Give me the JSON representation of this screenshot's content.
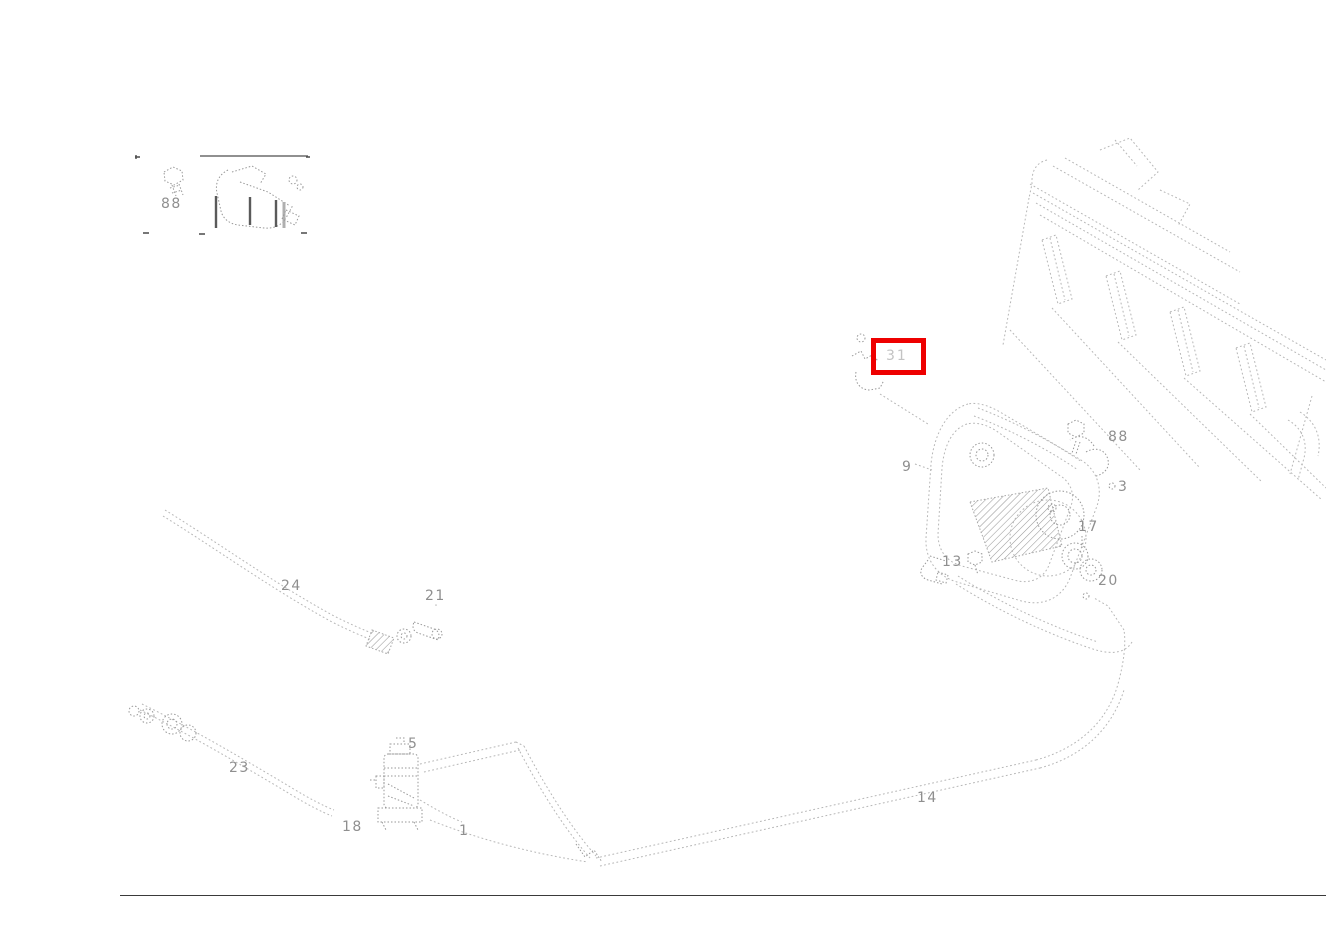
{
  "highlight": {
    "color": "#ee0000",
    "selected_part": "31"
  },
  "legend": {
    "fastener": "88"
  },
  "part_labels": [
    {
      "text": "31"
    },
    {
      "text": "88"
    },
    {
      "text": "9"
    },
    {
      "text": "3"
    },
    {
      "text": "17"
    },
    {
      "text": "20"
    },
    {
      "text": "13"
    },
    {
      "text": "24"
    },
    {
      "text": "21"
    },
    {
      "text": "23"
    },
    {
      "text": "5"
    },
    {
      "text": "18"
    },
    {
      "text": "1"
    },
    {
      "text": "14"
    }
  ]
}
